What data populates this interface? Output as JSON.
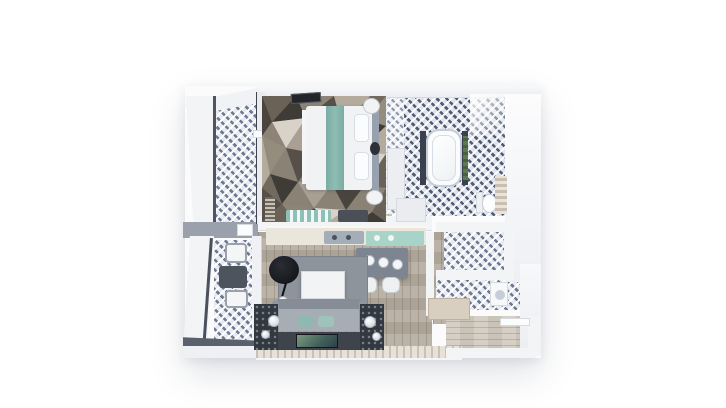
{
  "scene": {
    "type": "3d-floor-plan-render",
    "view": "top-down",
    "background": "#ffffff",
    "description": "Photorealistic bird's-eye 3D render of a one-bedroom apartment with two balconies"
  },
  "palette": {
    "wall": "#f3f4f6",
    "wall_edge": "#d5dae0",
    "dark_wall_edge": "#4e5560",
    "tile_base": "#e7eaf1",
    "tile_dash": "#5f6a84",
    "wood_living": "#b6ada0",
    "wood_entry": "#d2cbc0",
    "area_rug_gray": "#8d949c",
    "sofa_gray": "#a7adb5",
    "teal_accent": "#8fc0b8",
    "island_gray": "#7d8593",
    "lamp_black": "#17191d",
    "tv_screen_green": "#5a7a62",
    "rug_mosaic": [
      "#3f3b36",
      "#6b6257",
      "#8d8477",
      "#b5ab9c",
      "#d8d2c8",
      "#57504a",
      "#958c7e",
      "#4a443f",
      "#a9a093",
      "#726a5f"
    ]
  },
  "rooms": {
    "bedroom": {
      "label": "Bedroom",
      "furniture": [
        "double bed with teal runner",
        "pillows",
        "headboard",
        "foot bench",
        "round side table",
        "nightstand",
        "geometric mosaic rug",
        "wall TV",
        "wardrobe",
        "dresser",
        "teal striped bench",
        "radiator shelf"
      ]
    },
    "bedroom_balcony": {
      "label": "Bedroom balcony",
      "furniture": []
    },
    "bathroom": {
      "label": "Bathroom",
      "furniture": [
        "bathtub",
        "bath mats",
        "plant",
        "toilet",
        "towel ladder"
      ]
    },
    "living_kitchen": {
      "label": "Living room and kitchen",
      "furniture": [
        "kitchen counter with sink",
        "teal glass panel",
        "kitchen island with 3 pendant lights",
        "2 bar stools",
        "gray area rug",
        "white coffee table",
        "black arc floor lamp",
        "sphere lamp",
        "sofa with teal pillows",
        "2 dark side tables with sphere lamps",
        "TV console with TV"
      ]
    },
    "living_balcony": {
      "label": "Living room balcony",
      "furniture": [
        "armchair",
        "square table",
        "armchair"
      ]
    },
    "hallway": {
      "label": "Hallway",
      "furniture": [
        "shoe bench"
      ]
    },
    "closet": {
      "label": "Walk-in closet",
      "furniture": []
    },
    "wc": {
      "label": "Guest WC / laundry",
      "furniture": [
        "washer"
      ]
    },
    "entry": {
      "label": "Entry corridor",
      "furniture": [
        "entry door"
      ]
    }
  }
}
